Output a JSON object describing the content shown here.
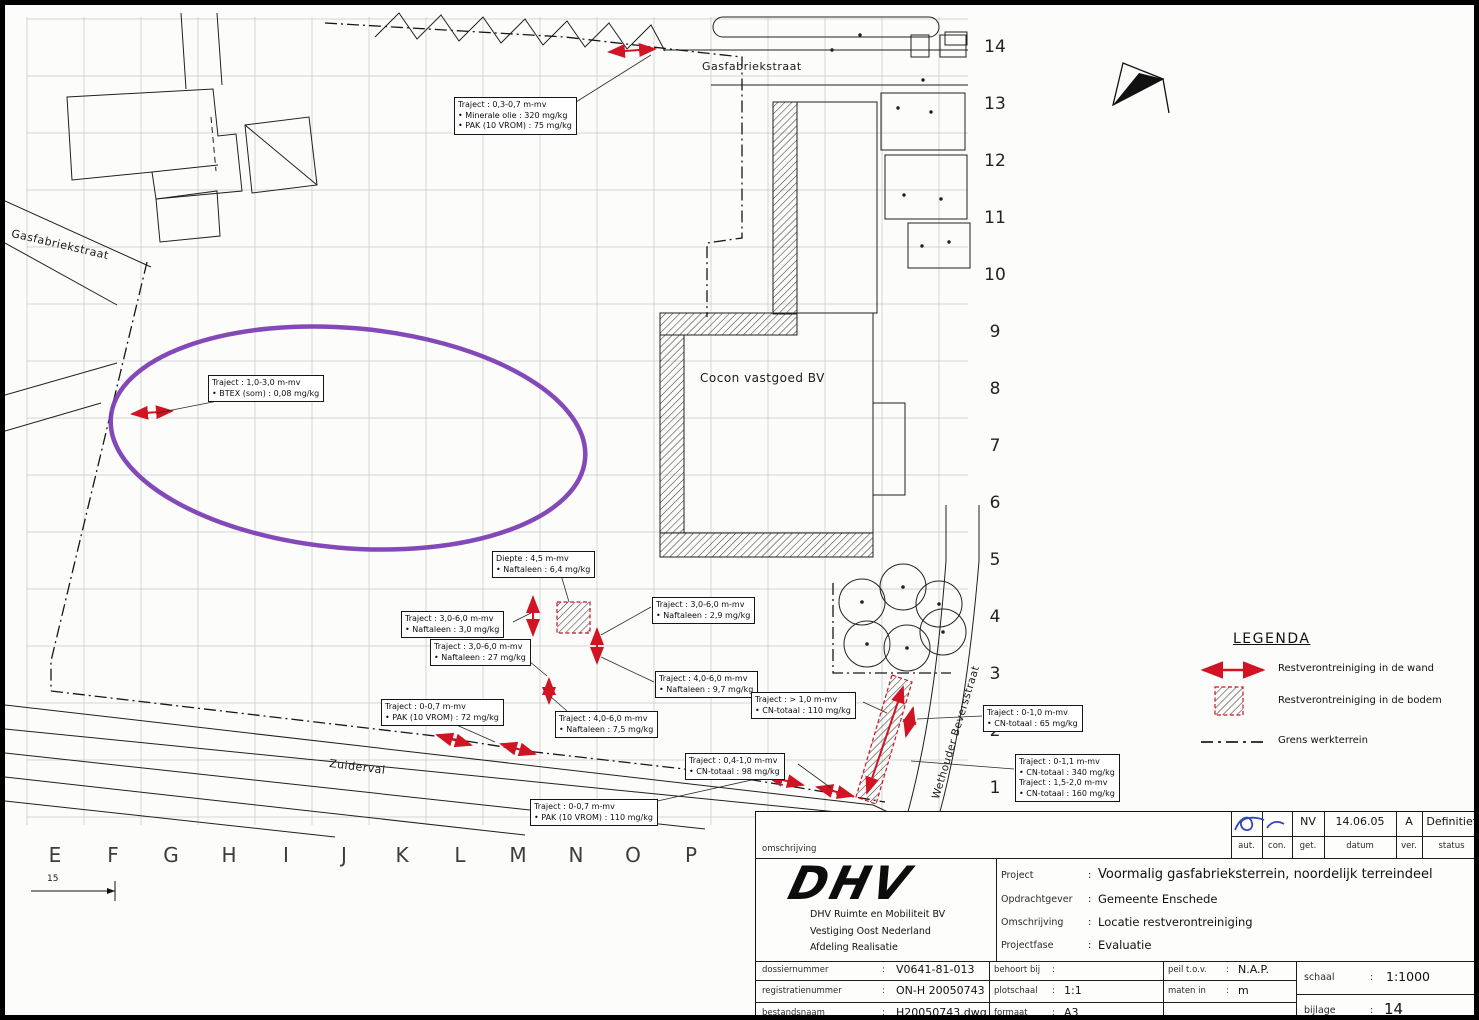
{
  "colors": {
    "arrow_red": "#d01423",
    "highlight_purple": "#7a3ab2"
  },
  "map": {
    "street_labels": {
      "gasfabriekstraat_top": "Gasfabriekstraat",
      "gasfabriekstraat_left": "Gasfabriekstraat",
      "zuiderval": "Zuiderval",
      "wethouder": "Wethouder Beversstraat"
    },
    "building_label": "Cocon vastgoed BV",
    "grid_letters": [
      "E",
      "F",
      "G",
      "H",
      "I",
      "J",
      "K",
      "L",
      "M",
      "N",
      "O",
      "P"
    ],
    "grid_numbers": [
      "14",
      "13",
      "12",
      "11",
      "10",
      "9",
      "8",
      "7",
      "6",
      "5",
      "4",
      "3",
      "2",
      "1"
    ],
    "dimension_label": "15"
  },
  "annotations": [
    {
      "lines": [
        "Traject : 0,3-0,7 m-mv",
        "• Minerale olie : 320 mg/kg",
        "• PAK (10 VROM) : 75 mg/kg"
      ]
    },
    {
      "lines": [
        "Traject : 1,0-3,0 m-mv",
        "• BTEX (som) : 0,08 mg/kg"
      ]
    },
    {
      "lines": [
        "Diepte : 4,5 m-mv",
        "• Naftaleen : 6,4 mg/kg"
      ]
    },
    {
      "lines": [
        "Traject : 3,0-6,0 m-mv",
        "• Naftaleen : 3,0 mg/kg"
      ]
    },
    {
      "lines": [
        "Traject : 3,0-6,0 m-mv",
        "• Naftaleen : 27 mg/kg"
      ]
    },
    {
      "lines": [
        "Traject : 3,0-6,0 m-mv",
        "• Naftaleen : 2,9 mg/kg"
      ]
    },
    {
      "lines": [
        "Traject : 4,0-6,0 m-mv",
        "• Naftaleen : 9,7 mg/kg"
      ]
    },
    {
      "lines": [
        "Traject : 0-0,7 m-mv",
        "• PAK (10 VROM) : 72 mg/kg"
      ]
    },
    {
      "lines": [
        "Traject : 4,0-6,0 m-mv",
        "• Naftaleen : 7,5 mg/kg"
      ]
    },
    {
      "lines": [
        "Traject : > 1,0 m-mv",
        "• CN-totaal : 110 mg/kg"
      ]
    },
    {
      "lines": [
        "Traject : 0-1,0 m-mv",
        "• CN-totaal : 65 mg/kg"
      ]
    },
    {
      "lines": [
        "Traject : 0,4-1,0 m-mv",
        "• CN-totaal : 98 mg/kg"
      ]
    },
    {
      "lines": [
        "Traject : 0-1,1 m-mv",
        "• CN-totaal : 340 mg/kg",
        "Traject : 1,5-2,0 m-mv",
        "• CN-totaal : 160 mg/kg"
      ]
    },
    {
      "lines": [
        "Traject : 0-0,7 m-mv",
        "• PAK (10 VROM) : 110 mg/kg"
      ]
    }
  ],
  "legend": {
    "title": "LEGENDA",
    "items": [
      {
        "label": "Restverontreiniging in de wand"
      },
      {
        "label": "Restverontreiniging in de bodem"
      },
      {
        "label": "Grens werkterrein"
      }
    ]
  },
  "titleblock": {
    "colon": ":",
    "omschrijving_label": "omschrijving",
    "approval": {
      "values": [
        "",
        "",
        "NV",
        "14.06.05",
        "A",
        "Definitief"
      ],
      "labels": [
        "aut.",
        "con.",
        "get.",
        "datum",
        "ver.",
        "status"
      ]
    },
    "company": {
      "logo_text": "DHV",
      "name_lines": [
        "DHV Ruimte en Mobiliteit BV",
        "Vestiging Oost Nederland",
        "Afdeling Realisatie"
      ]
    },
    "project_rows": [
      {
        "label": "Project",
        "value": "Voormalig gasfabrieksterrein, noordelijk terreindeel"
      },
      {
        "label": "Opdrachtgever",
        "value": "Gemeente Enschede"
      },
      {
        "label": "Omschrijving",
        "value": "Locatie restverontreiniging"
      },
      {
        "label": "Projectfase",
        "value": "Evaluatie"
      }
    ],
    "meta_left": [
      {
        "label": "dossiernummer",
        "value": "V0641-81-013"
      },
      {
        "label": "registratienummer",
        "value": "ON-H 20050743"
      },
      {
        "label": "bestandsnaam",
        "value": "H20050743.dwg"
      }
    ],
    "meta_mid": [
      {
        "label": "behoort bij",
        "value": ""
      },
      {
        "label": "plotschaal",
        "value": "1:1"
      },
      {
        "label": "formaat",
        "value": "A3"
      }
    ],
    "meta_peil": [
      {
        "label": "peil t.o.v.",
        "value": "N.A.P."
      },
      {
        "label": "maten in",
        "value": "m"
      }
    ],
    "schaal": {
      "label": "schaal",
      "value": "1:1000"
    },
    "bijlage": {
      "label": "bijlage",
      "value": "14"
    }
  }
}
